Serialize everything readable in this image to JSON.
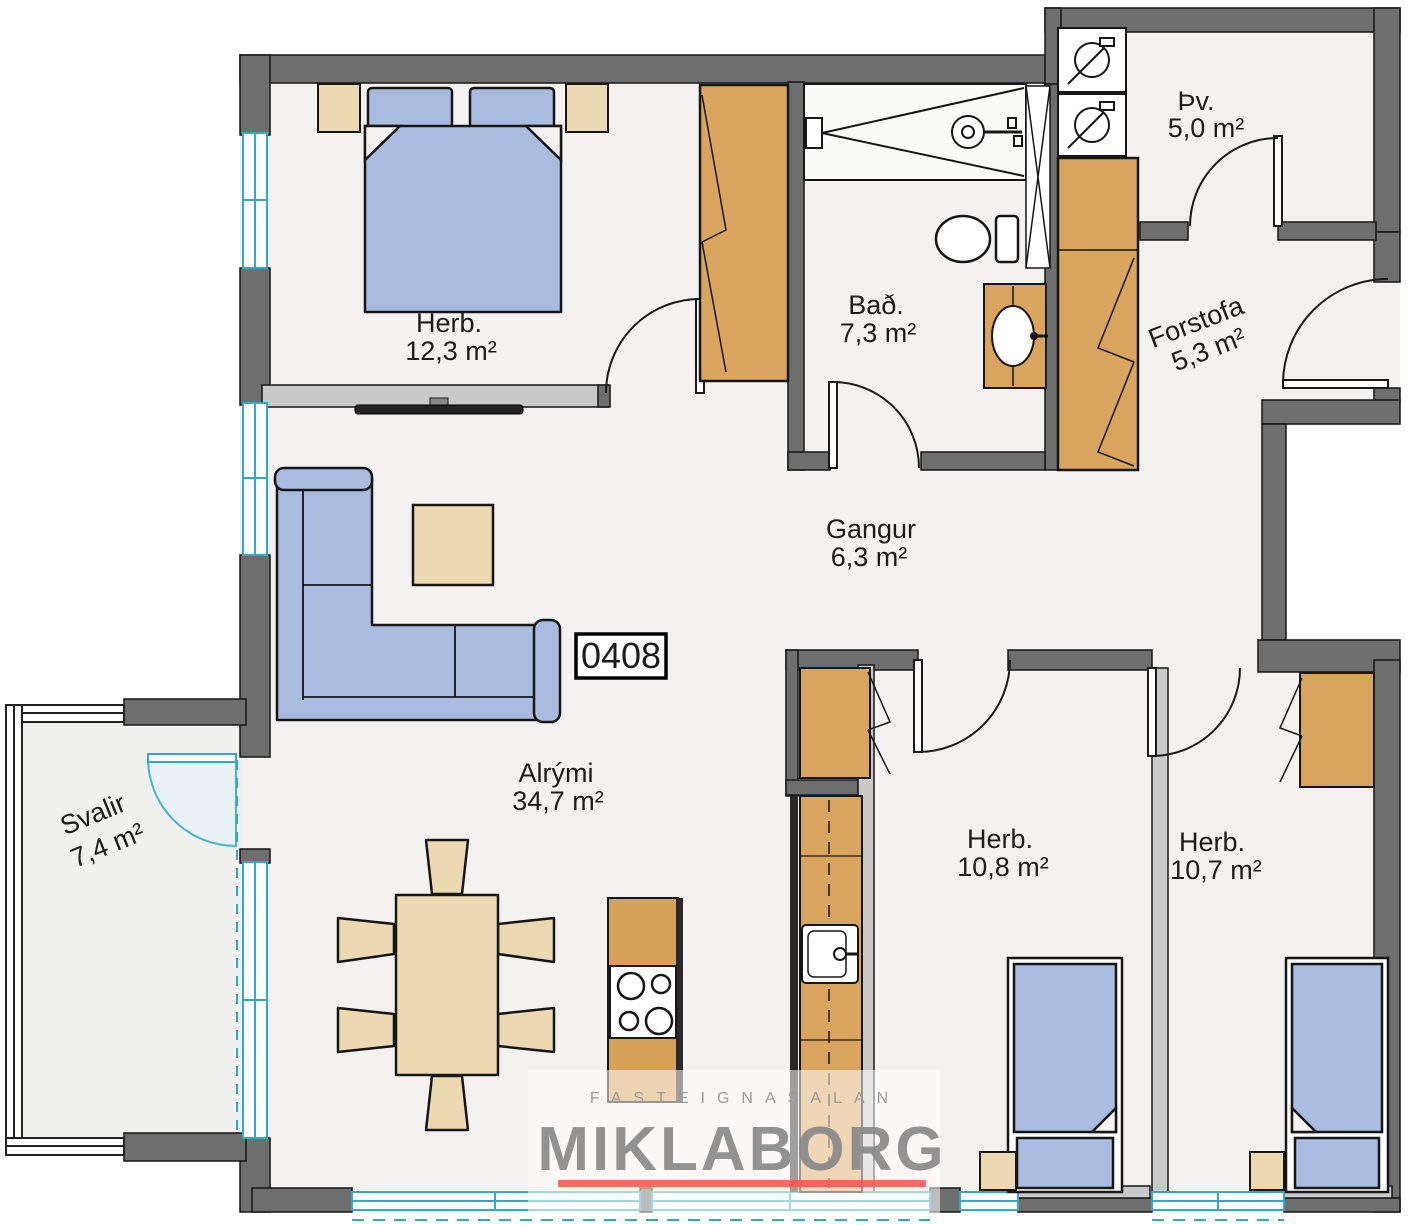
{
  "unit_number": "0408",
  "rooms": {
    "bedroom_master": {
      "name": "Herb.",
      "area": "12,3 m²"
    },
    "bathroom": {
      "name": "Bað.",
      "area": "7,3 m²"
    },
    "laundry": {
      "name": "Þv.",
      "area": "5,0 m²"
    },
    "entrance": {
      "name": "Forstofa",
      "area": "5,3 m²"
    },
    "hallway": {
      "name": "Gangur",
      "area": "6,3 m²"
    },
    "living": {
      "name": "Alrými",
      "area": "34,7 m²"
    },
    "balcony": {
      "name": "Svalir",
      "area": "7,4 m²"
    },
    "bedroom_2": {
      "name": "Herb.",
      "area": "10,8 m²"
    },
    "bedroom_3": {
      "name": "Herb.",
      "area": "10,7 m²"
    }
  },
  "watermark": {
    "tagline": "FASTEIGNASALAN",
    "brand": "MIKLABORG"
  },
  "icons": {
    "door-swing-icon": "quarter-circle arc",
    "window-icon": "cyan double line",
    "double-bed-icon": "rect with two pillows",
    "single-bed-icon": "rect with pillow and folded corner",
    "wardrobe-icon": "tan rect with folding-door chevrons",
    "sofa-icon": "L-shaped sectional",
    "coffee-table-icon": "square",
    "dining-table-icon": "rect with six chairs",
    "cooktop-icon": "four burner circles",
    "kitchen-sink-icon": "square basin with faucet",
    "washing-machine-icon": "square with drum circle",
    "shower-icon": "spray triangles with shower head",
    "toilet-icon": "bowl with cistern",
    "bathroom-sink-icon": "oval basin in vanity",
    "tv-icon": "thin wall bar"
  },
  "colors": {
    "wall": "#6e6e6e",
    "partition": "#c9c9c9",
    "floor": "#f3f2f0",
    "furniture_wood": "#d9a55e",
    "furniture_light": "#ecd9b2",
    "furniture_blue": "#a9bcdf",
    "window": "#2fa9c4",
    "watermark_gray": "#8a8a8a",
    "watermark_red": "#f2544b",
    "label": "#1c1c1c"
  }
}
